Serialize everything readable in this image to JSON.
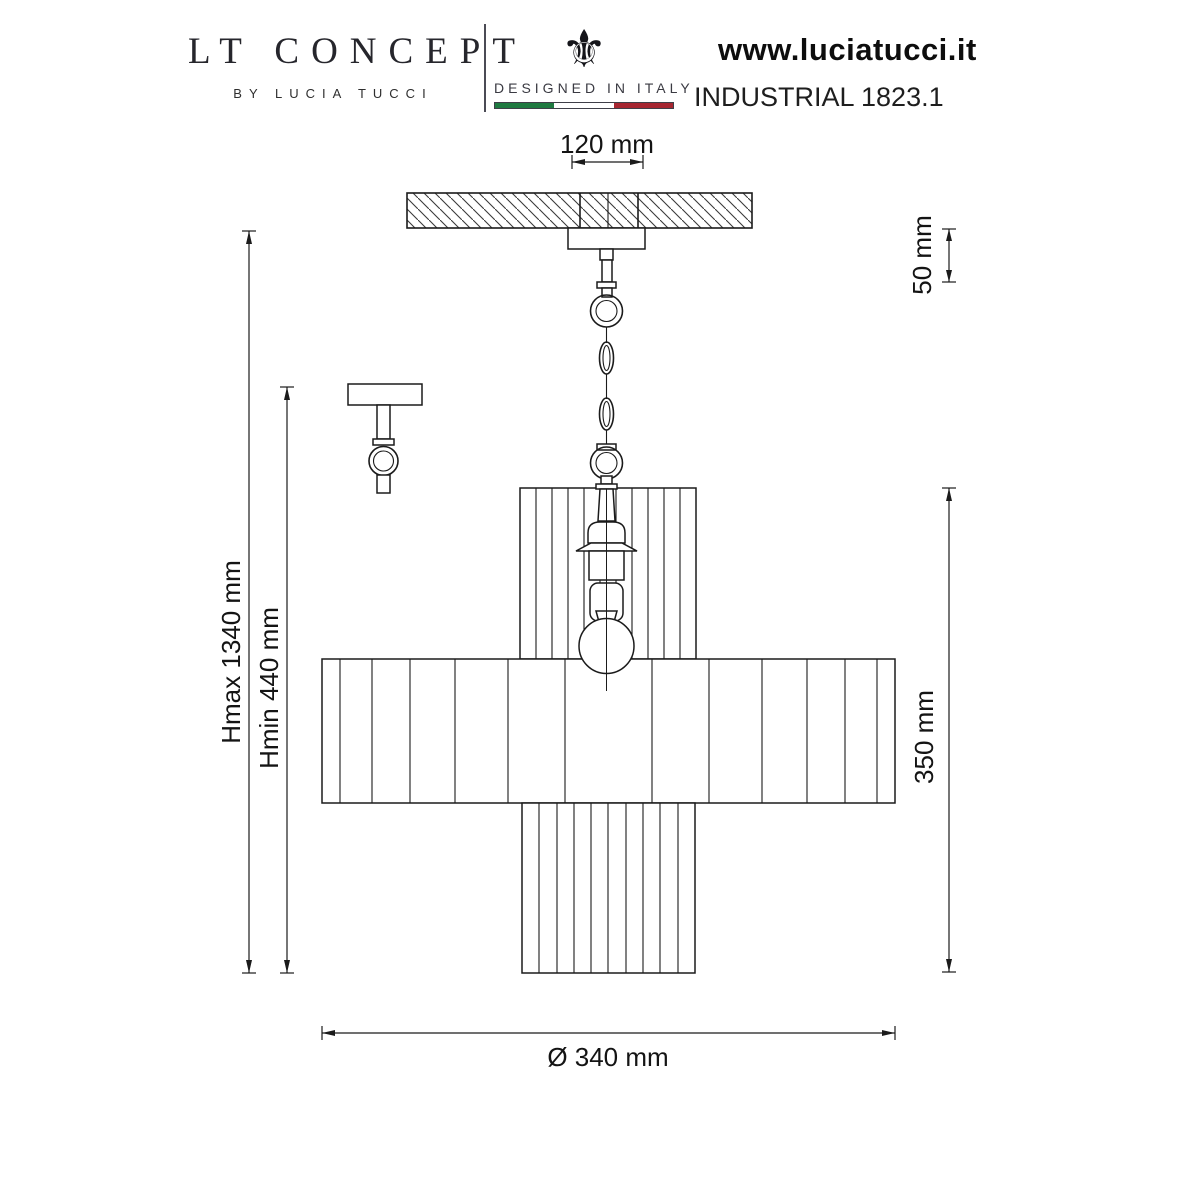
{
  "header": {
    "brand": "LT CONCEPT",
    "brand_byline": "BY LUCIA TUCCI",
    "made_in": {
      "label": "DESIGNED IN ITALY",
      "icon": "fleur-de-lis-icon",
      "icon_glyph": "⚜",
      "flag_green": "#1f7a41",
      "flag_white": "#ffffff",
      "flag_red": "#a62631"
    },
    "website": "www.luciatucci.it",
    "model": "INDUSTRIAL 1823.1"
  },
  "drawing": {
    "line_color": "#1b1b1b",
    "dims": {
      "canopy_width": "120 mm",
      "canopy_drop": "50 mm",
      "hmax": "Hmax 1340 mm",
      "hmin": "Hmin 440 mm",
      "shade_height": "350 mm",
      "diameter": "Ø 340 mm"
    }
  }
}
